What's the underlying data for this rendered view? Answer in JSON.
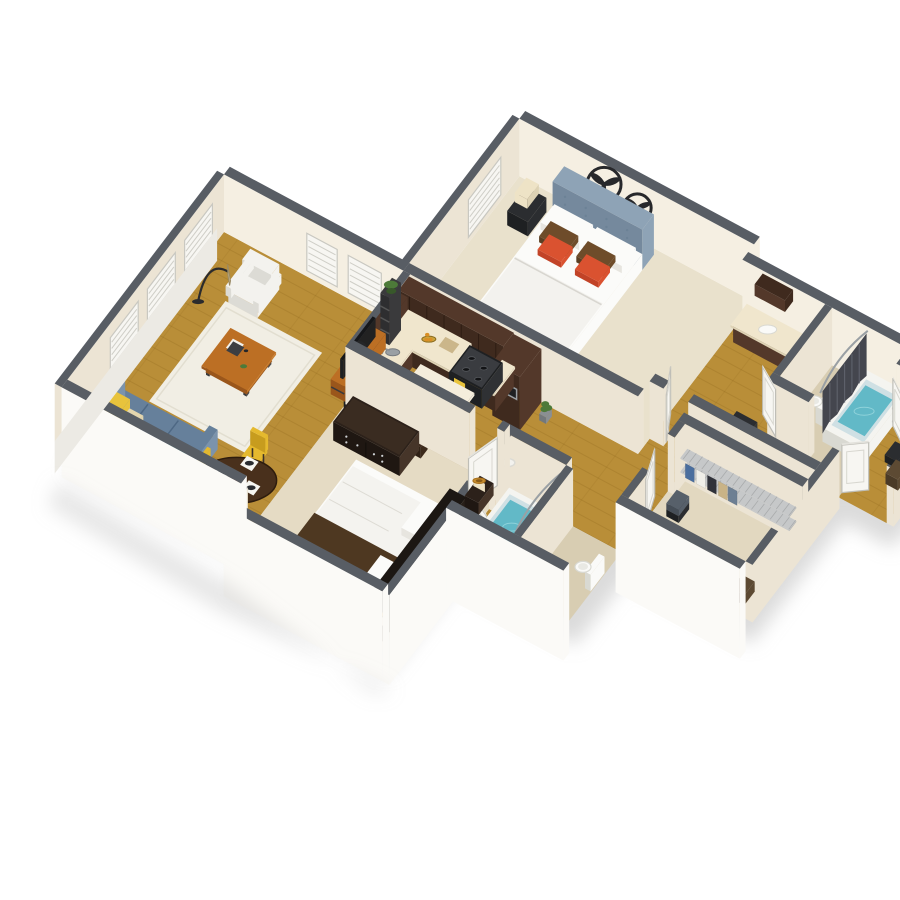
{
  "meta": {
    "title": "3D isometric floor plan render — two bedroom, two bath apartment",
    "background": "#ffffff"
  },
  "palette": {
    "bg": "#ffffff",
    "shadow": "#bdbdbd",
    "wallTop": "#585d64",
    "wallTopDark": "#4c5158",
    "wallInner": "#ece4d4",
    "wallInnerLight": "#f5efe2",
    "wallInnerShade": "#ded6c3",
    "wallOuter": "#fbfaf7",
    "wallOuterShade": "#eceae4",
    "floorWood": "#b98e38",
    "floorWoodLine": "#7a5412",
    "carpetMaster": "#e9e1cc",
    "carpetBed2": "#e5dbc4",
    "carpetCloset": "#e2d8c0",
    "tileTan": "#d8cdb2",
    "tileBlue": "#cfe0e4",
    "water": "#62b9c7",
    "waterDeep": "#3f9fb0",
    "tubWhite": "#f4f4f0",
    "fixtureWhite": "#fafaf8",
    "fixtureShade": "#d9d9d2",
    "cabinet": "#53382a",
    "cabinetDark": "#3f2a1e",
    "cabinetLine": "#2e1d13",
    "counter": "#f0e6cd",
    "counterShade": "#ddd2b4",
    "steel": "#9aa0a4",
    "black": "#1e2022",
    "blackSoft": "#2b2d30",
    "sofa": "#66809b",
    "sofaLight": "#7b93ac",
    "sofaDark": "#55708c",
    "pillowYellow": "#e8c33c",
    "pillowPattern": "#e4d6ae",
    "pillowTeal": "#3aa89e",
    "chairWhite": "#f3f2ee",
    "chairWhiteShade": "#dcdbd5",
    "woodFurn": "#bc6f24",
    "woodFurnDark": "#9a561b",
    "frameDark": "#3a3a3c",
    "rug": "#f1eee4",
    "rugShade": "#e2ded0",
    "bedWhite": "#fbfbf9",
    "bedShade": "#e7e5df",
    "headboard": "#8ea3b6",
    "headboardDark": "#75899d",
    "pillowOrange": "#da5230",
    "pillowBrown": "#6e4c2a",
    "runnerBrown": "#4e3821",
    "dresser": "#2c211a",
    "dresserHi": "#463529",
    "lampShade": "#eee3c6",
    "lampGold": "#c78d2e",
    "curtain": "#44464e",
    "curtainFold": "#5d606a",
    "doorWhite": "#f7f6f2",
    "doorShade": "#e3e2dc",
    "doorEdge": "#c9c8c1",
    "wire": "#c6c8c9",
    "yellowChair": "#e5b92e",
    "yellowChairDark": "#c79c1e",
    "tableDark": "#49301c",
    "plant": "#4d7a39",
    "plantDark": "#38582a",
    "fanDark": "#27282b",
    "shelfTan": "#cbb68a"
  },
  "scene": {
    "type": "isometric-floorplan-3d",
    "rooms": [
      {
        "name": "master-bedroom",
        "floor": "carpet"
      },
      {
        "name": "master-bathroom",
        "floor": "tile"
      },
      {
        "name": "hall-bath-corridor",
        "floor": "wood"
      },
      {
        "name": "kitchen",
        "floor": "wood"
      },
      {
        "name": "living-room",
        "floor": "wood"
      },
      {
        "name": "dining-nook",
        "floor": "wood"
      },
      {
        "name": "second-bedroom",
        "floor": "carpet"
      },
      {
        "name": "second-bathroom",
        "floor": "tile"
      },
      {
        "name": "walk-in-closet",
        "floor": "carpet"
      },
      {
        "name": "linen-closet",
        "floor": "wood"
      }
    ],
    "objects": [
      "master-bed",
      "tufted-headboard",
      "wall-fans",
      "table-lamp",
      "nightstand",
      "window-shutters",
      "kitchen-l-counter",
      "upper-cabinets",
      "refrigerator",
      "range-stove",
      "wall-oven-microwave",
      "kitchen-sink",
      "kitchen-island",
      "bar-stools",
      "fruit-bowl",
      "tv-console",
      "flat-tv",
      "plant-shelf",
      "accent-armchair",
      "arc-floor-lamp",
      "area-rug",
      "coffee-table",
      "sofa",
      "throw-pillows",
      "side-table",
      "dining-table",
      "dining-chairs",
      "place-settings",
      "dresser",
      "bedroom2-bed",
      "drum-lamps",
      "bathtub",
      "shower-curtain",
      "toilet",
      "pedestal-sink",
      "bathroom-vanity",
      "wire-closet-shelving",
      "hanging-clothes",
      "storage-baskets",
      "interior-doors",
      "washer-dryer"
    ]
  }
}
